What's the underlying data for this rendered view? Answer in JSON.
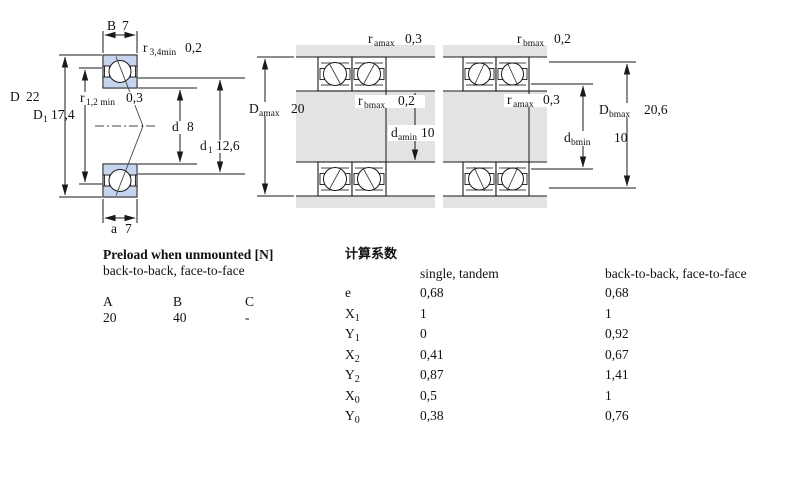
{
  "diagram": {
    "left": {
      "B": {
        "main": "B",
        "value": "7"
      },
      "r34": {
        "main": "r",
        "sub": "3,4min",
        "value": "0,2"
      },
      "D": {
        "main": "D",
        "value": "22"
      },
      "r12": {
        "main": "r",
        "sub": "1,2 min",
        "value": "0,3"
      },
      "D1": {
        "main": "D",
        "sub": "1",
        "value": "17,4"
      },
      "d": {
        "main": "d",
        "value": "8"
      },
      "d1": {
        "main": "d",
        "sub": "1",
        "value": "12,6"
      },
      "a": {
        "main": "a",
        "value": "7"
      }
    },
    "middle": {
      "r_amax": {
        "main": "r",
        "sub": "amax",
        "value": "0,3"
      },
      "D_amax": {
        "main": "D",
        "sub": "amax",
        "value": "20"
      },
      "r_bmax": {
        "main": "r",
        "sub": "bmax",
        "value": "0,2"
      },
      "d_amin": {
        "main": "d",
        "sub": "amin",
        "value": "10"
      }
    },
    "right": {
      "r_bmax": {
        "main": "r",
        "sub": "bmax",
        "value": "0,2"
      },
      "r_amax": {
        "main": "r",
        "sub": "amax",
        "value": "0,3"
      },
      "D_bmax": {
        "main": "D",
        "sub": "bmax",
        "value": "20,6"
      },
      "d_bmin": {
        "main": "d",
        "sub": "bmin",
        "value": "10"
      }
    },
    "colors": {
      "ring_fill": "#c7d4ee",
      "shaft_fill": "#e3e3e3",
      "line": "#1a1a1a"
    }
  },
  "preload_table": {
    "title": "Preload when unmounted [N]",
    "subtitle": "back-to-back, face-to-face",
    "columns": [
      "A",
      "B",
      "C"
    ],
    "values": [
      "20",
      "40",
      "-"
    ]
  },
  "factors_table": {
    "title": "计算系数",
    "col1_header": "single, tandem",
    "col2_header": "back-to-back, face-to-face",
    "rows": [
      {
        "label": "e",
        "sub": "",
        "v1": "0,68",
        "v2": "0,68"
      },
      {
        "label": "X",
        "sub": "1",
        "v1": "1",
        "v2": "1"
      },
      {
        "label": "Y",
        "sub": "1",
        "v1": "0",
        "v2": "0,92"
      },
      {
        "label": "X",
        "sub": "2",
        "v1": "0,41",
        "v2": "0,67"
      },
      {
        "label": "Y",
        "sub": "2",
        "v1": "0,87",
        "v2": "1,41"
      },
      {
        "label": "X",
        "sub": "0",
        "v1": "0,5",
        "v2": "1"
      },
      {
        "label": "Y",
        "sub": "0",
        "v1": "0,38",
        "v2": "0,76"
      }
    ]
  }
}
